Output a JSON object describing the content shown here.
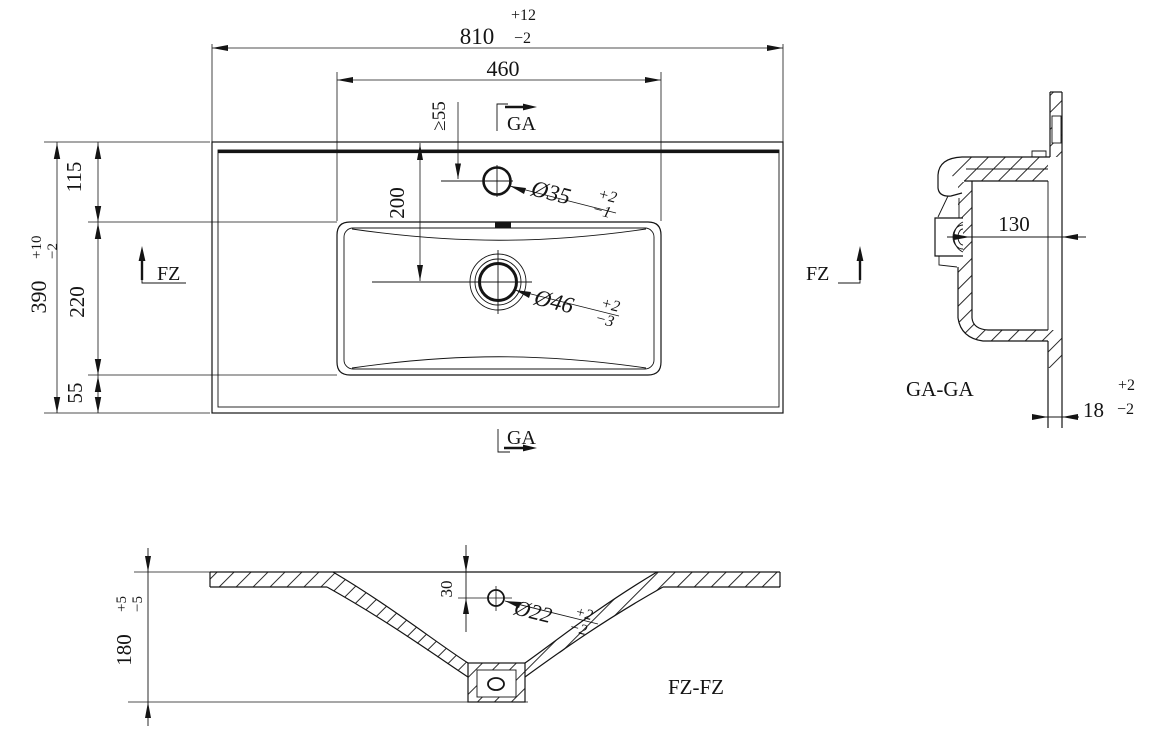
{
  "colors": {
    "ink": "#141414",
    "paper": "#ffffff"
  },
  "plan": {
    "d810": {
      "v": "810",
      "tu": "+12",
      "td": "−2"
    },
    "d460": {
      "v": "460"
    },
    "d390": {
      "v": "390",
      "tu": "+10",
      "td": "−2"
    },
    "d115": {
      "v": "115"
    },
    "d220": {
      "v": "220"
    },
    "d55": {
      "v": "55"
    },
    "dmin55": {
      "v": "≥55"
    },
    "d200": {
      "v": "200"
    },
    "dia35": {
      "v": "Ø35",
      "tu": "+2",
      "td": "−1"
    },
    "dia46": {
      "v": "Ø46",
      "tu": "+2",
      "td": "−3"
    },
    "ga": "GA",
    "fz": "FZ"
  },
  "section_ga": {
    "label": "GA-GA",
    "d130": {
      "v": "130"
    },
    "d18": {
      "v": "18",
      "tu": "+2",
      "td": "−2"
    }
  },
  "section_fz": {
    "label": "FZ-FZ",
    "d180": {
      "v": "180",
      "tu": "+5",
      "td": "−5"
    },
    "d30": {
      "v": "30"
    },
    "dia22": {
      "v": "Ø22",
      "tu": "+2",
      "td": "−2"
    }
  }
}
